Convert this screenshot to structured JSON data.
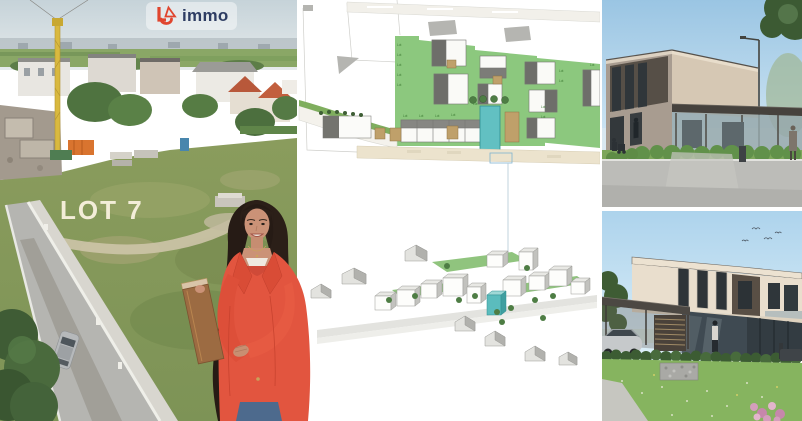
{
  "logo": {
    "mark_letters": "LA",
    "text": "immo",
    "mark_color": "#e0452e",
    "text_color": "#2e3d63"
  },
  "aerial_photo": {
    "lot_label": "LOT 7",
    "lot_label_color": "#f3edd8"
  },
  "site_plan": {
    "lot_label_prefix": "Lot",
    "highlight_color": "#62c0c2",
    "highlight_building_color": "#5bbcbd",
    "lawn_color": "#8cc87e",
    "garage_color": "#bfa06a",
    "leader_line_color": "#b3c8d6"
  },
  "renders": {
    "top": {
      "sky_color": "#9ac5e3",
      "facade_color": "#d6c8b4",
      "canopy_color": "#46423d"
    },
    "bottom": {
      "sky_color": "#add3ec",
      "facade_color": "#e9decd",
      "cladding_color": "#594f45",
      "lawn_color": "#86b45f"
    }
  },
  "agent": {
    "blazer_color": "#e2553f",
    "top_color": "#cf4a38",
    "folder_color": "#9c6b42",
    "jeans_color": "#4d6a8d"
  }
}
